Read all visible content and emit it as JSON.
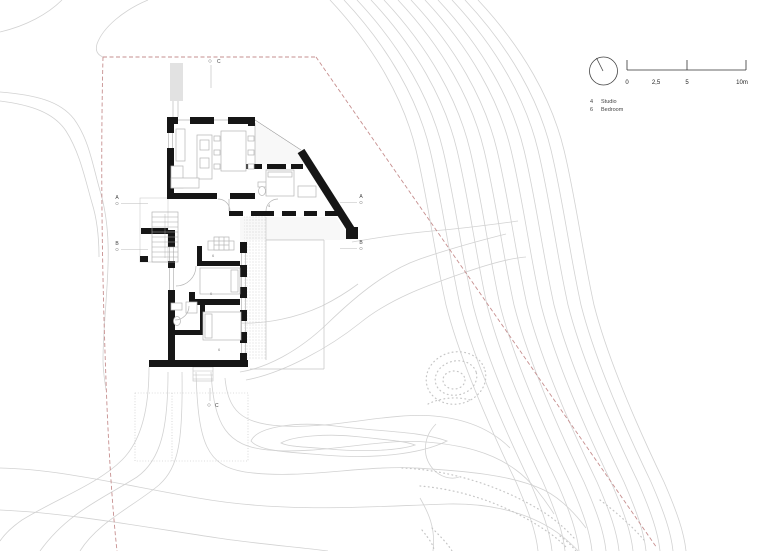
{
  "drawing": {
    "type": "architectural site plan with floor plan",
    "sheet": "ground floor / site"
  },
  "markers": {
    "left_top": "A",
    "left_bottom": "B",
    "right_top": "A",
    "right_bottom": "B",
    "top": "C",
    "bottom": "C"
  },
  "scale_bar": {
    "tick_labels": [
      "0",
      "2,5",
      "5",
      "10m"
    ]
  },
  "legend": {
    "entries": [
      {
        "key": "4",
        "label": "Studio"
      },
      {
        "key": "6",
        "label": "Bedroom"
      }
    ]
  },
  "room_numbers": {
    "studio": "4",
    "bedroom": "6"
  },
  "colors": {
    "walls": "#161616",
    "boundary": "#c68f8f",
    "contours": "#d2d2d2",
    "furniture": "#b5b5b5",
    "text": "#444444"
  }
}
